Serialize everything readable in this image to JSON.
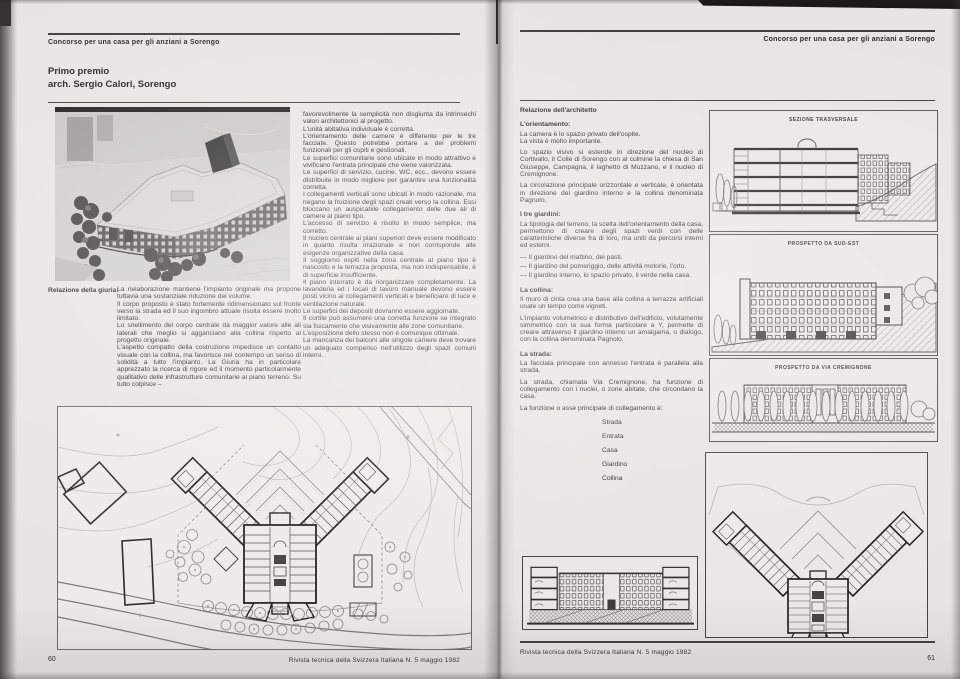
{
  "running_head": "Concorso per una casa per gli anziani a Sorengo",
  "footer_journal": "Rivista tecnica della Svizzera Italiana N. 5 maggio 1982",
  "left_page": {
    "page_number": "60",
    "title_line1": "Primo premio",
    "title_line2": "arch. Sergio Calori, Sorengo",
    "jury_label": "Relazione della giuria:",
    "jury_col1": [
      "La rielaborazione mantiene l'impianto originale ma propone tuttavia una sostanziale riduzione del volume.",
      "Il corpo proposto è stato fortemente ridimensionato sul fronte verso la strada ed il suo ingombro attuale risulta essere molto limitato.",
      "Lo snellimento del corpo centrale dà maggior valore alle ali laterali che meglio si agganciano alla collina rispetto al progetto originale.",
      "L'aspetto compatto della costruzione impedisce un contatto visuale con la collina, ma favorisce nel contempo un senso di solidità a tutto l'impianto. La Giuria ha in particolare apprezzato la ricerca di rigore ed il momento particolarmente qualitativo delle infrastrutture comunitarie al piano terreno. Su tutto colpisce –"
    ],
    "jury_col2": [
      "favorevolmente la semplicità non disgiunta da intrinsechi valori architettonici al progetto.",
      "L'unità abitativa individuale è corretta.",
      "L'orientamento delle camere è differente per le tre facciate. Questo potrebbe portare a dei problemi funzionali per gli ospiti e gestionali.",
      "Le superfici comunitarie sono ubicate in modo attrattivo e vivificano l'entrata principale che viene valorizzata.",
      "Le superfici di servizio, cucine, WC, ecc., devono essere distribuite in modo migliore per garantire una funzionalità corretta.",
      "I collegamenti verticali sono ubicati in modo razionale, ma negano la fruizione degli spazi creati verso la collina. Essi bloccano un auspicabile collegamento delle due ali di camere al piano tipo.",
      "L'accesso di servizio è risolto in modo semplice, ma corretto.",
      "Il nucleo centrale ai piani superiori deve essere modificato in quanto risulta irrazionale e non corrisponde alle esigenze organizzative della casa.",
      "Il soggiorno ospiti nella zona centrale al piano tipo è nascosto e la terrazza proposta, ma non indispensabile, è di superficie insufficiente.",
      "Il piano interrato è da riorganizzare completamente. La lavanderia ed i locali di lavoro manuale devono essere posti vicino ai collegamenti verticali e beneficiare di luce e ventilazione naturale.",
      "Le superfici dei depositi dovranno essere aggiornate.",
      "Il cortile può assumere una corretta funzione se integrato sia fisicamente che visivamente alle zone comunitarie.",
      "L'esposizione dello stesso non è comunque ottimale.",
      "La mancanza dei balconi alle singole camere deve trovare un adeguato compenso nell'utilizzo degli spazi comuni interni."
    ]
  },
  "right_page": {
    "page_number": "61",
    "architect_title": "Relazione dell'architetto",
    "sections": {
      "orientamento_heading": "L'orientamento:",
      "orientamento": [
        "La camera è lo spazio privato dell'ospite.",
        "La vista è molto importante.",
        "Lo spazio visivo si estende in direzione del nucleo di Cortivallo, il Colle di Sorengo con al culmine la chiesa di San Giuseppe, Campagna, il laghetto di Muzzano, e il nucleo di Cremignone.",
        "La circolazione principale orizzontale e verticale, è orientata in direzione del giardino interno e la collina denominata Pagnolo."
      ],
      "giardini_heading": "I tre giardini:",
      "giardini_intro": "La tipologia del terreno, la scelta dell'orientamento della casa, permettono di creare degli spazi verdi con delle caratteristiche diverse fra di loro, ma uniti da percorsi interni ed esterni.",
      "giardini_bullets": [
        "—  Il giardino del mattino, dei pasti.",
        "—  Il giardino del pomeriggio, delle attività motorie, l'orto.",
        "—  Il giardino interno, lo spazio privato, il verde nella casa."
      ],
      "collina_heading": "La collina:",
      "collina": [
        "Il muro di cinta crea una base alla collina a terrazze artificiali usate un tempo come vigneti.",
        "L'impianto volumetrico e distributivo dell'edificio, volutamente simmetrico con la sua forma particolare a Y, permette di creare attraverso il giardino interno un amalgama, o dialogo, con la collina denominata Pagnolo."
      ],
      "strada_heading": "La strada:",
      "strada": [
        "La facciata principale con annesso l'entrata è parallela alla strada.",
        "La strada, chiamata Via Cremignone, ha funzione di collegamento con i nuclei, o zone abitate, che circondano la casa.",
        "La funzione o asse principale di collegamento è:"
      ]
    },
    "axis_list": [
      "Strada",
      "Entrata",
      "Casa",
      "Giardino",
      "Collina"
    ],
    "drawing_labels": {
      "sezione": "SEZIONE TRASVERSALE",
      "prospetto_sud_est": "PROSPETTO DA SUD-EST",
      "prospetto_via": "PROSPETTO DA VIA CREMIGNONE"
    }
  }
}
